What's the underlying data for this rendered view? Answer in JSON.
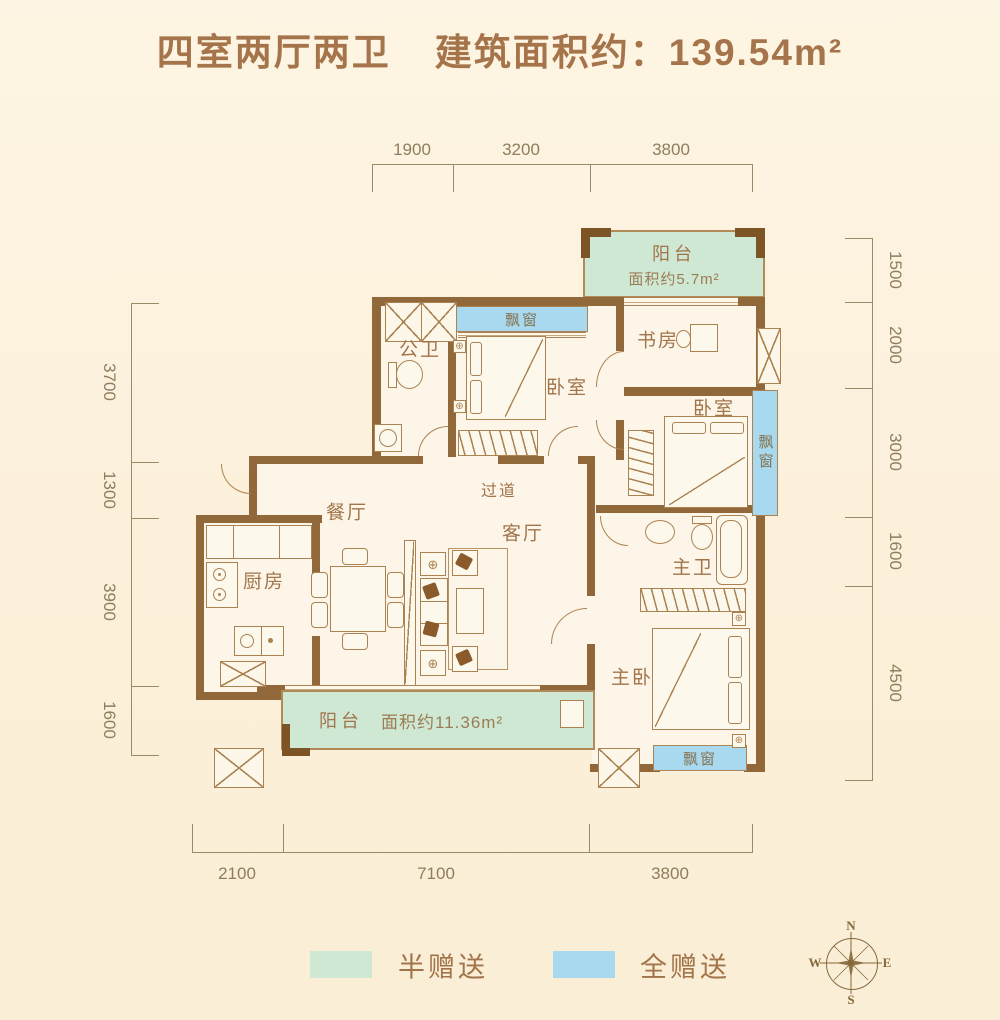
{
  "title": {
    "layout": "四室两厅两卫",
    "area": "建筑面积约：139.54m²"
  },
  "dimensions": {
    "top": [
      "1900",
      "3200",
      "3800"
    ],
    "bottom": [
      "2100",
      "7100",
      "3800"
    ],
    "left": [
      "3700",
      "1300",
      "3900",
      "1600"
    ],
    "right": [
      "1500",
      "2000",
      "3000",
      "1600",
      "4500"
    ]
  },
  "rooms": {
    "balcony_top": {
      "name": "阳台",
      "area": "面积约5.7m²"
    },
    "bay_window_top": "飘窗",
    "public_bath": "公卫",
    "bedroom_top": "卧室",
    "study": "书房",
    "bedroom_right": "卧室",
    "bay_window_right": "飘窗",
    "dining": "餐厅",
    "corridor": "过道",
    "living": "客厅",
    "kitchen": "厨房",
    "master_bath": "主卫",
    "master_bedroom": "主卧",
    "balcony_bottom": {
      "name": "阳台",
      "area": "面积约11.36m²"
    },
    "bay_window_bottom": "飘窗"
  },
  "legend": [
    {
      "label": "半赠送",
      "color": "#cfe8d4"
    },
    {
      "label": "全赠送",
      "color": "#a9d9ee"
    }
  ],
  "compass": {
    "north": "N",
    "east": "E",
    "south": "S",
    "west": "W"
  },
  "colors": {
    "wall": "#91683a",
    "accent_text": "#a5744a",
    "dimension_text": "#8f7d5e",
    "half_free_green": "#cfe8d4",
    "full_free_blue": "#a9d9ee",
    "background": "#fcf0da"
  }
}
